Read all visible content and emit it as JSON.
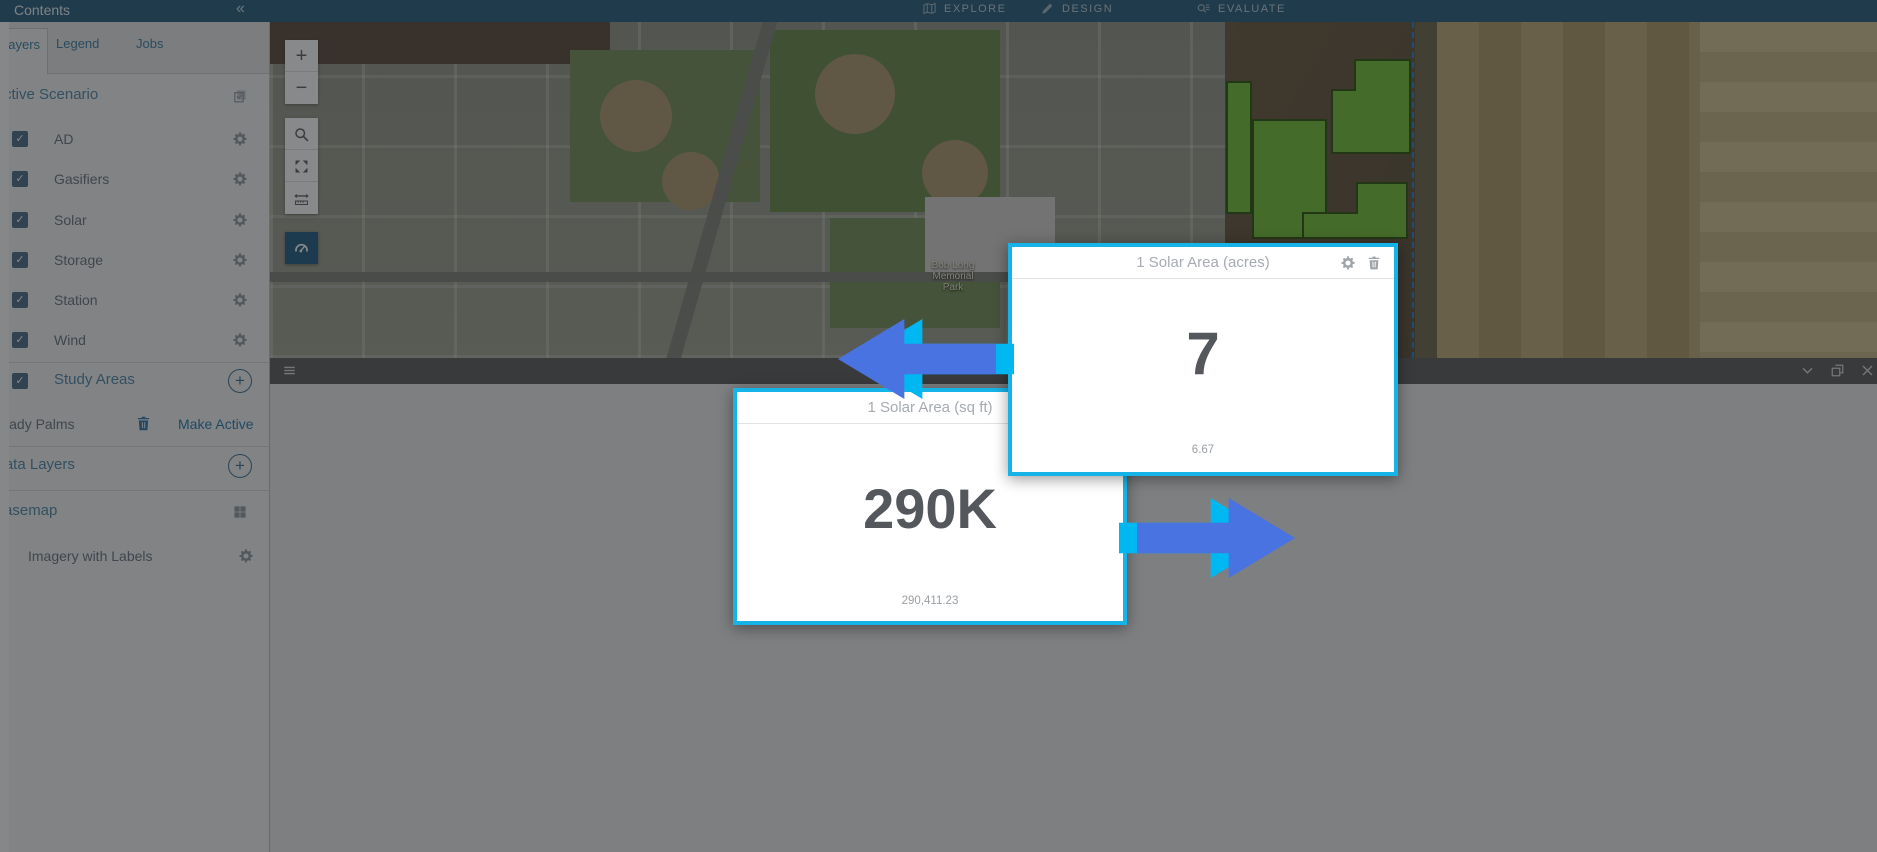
{
  "icons": {
    "plus": "+",
    "collapse": "«",
    "check": "✓",
    "zoom_in": "+",
    "zoom_out": "−"
  },
  "topbar": {
    "contents_title": "Contents",
    "explore": "EXPLORE",
    "design": "DESIGN",
    "evaluate": "EVALUATE"
  },
  "sidebar": {
    "tabs": {
      "layers": "Layers",
      "legend": "Legend",
      "jobs": "Jobs"
    },
    "active_scenario_label": "Active Scenario",
    "layers": [
      {
        "name": "AD"
      },
      {
        "name": "Gasifiers"
      },
      {
        "name": "Solar"
      },
      {
        "name": "Storage"
      },
      {
        "name": "Station"
      },
      {
        "name": "Wind"
      }
    ],
    "study_areas_label": "Study Areas",
    "study_area": {
      "name": "Shady Palms",
      "action": "Make Active"
    },
    "data_layers_label": "Data Layers",
    "basemap_label": "Basemap",
    "basemap_layer": "Imagery with Labels"
  },
  "map": {
    "park_label": [
      "Bob Long",
      "Memorial",
      "Park"
    ]
  },
  "dashboard": {
    "design_chart": {
      "title": "Design Chart",
      "left_select": "Solar",
      "right_select": "solar test",
      "footer": "Solar Lizard",
      "left_pie": "#68aa37 0deg 360deg",
      "right_pie": "#7d923f 0deg 25deg, #41703a 25deg 95deg, #57973d 95deg 130deg, #7d923f 130deg 360deg"
    },
    "solar_area_sqft": {
      "title": "1 Solar Area (sq ft)",
      "value": "290K",
      "footer": "290,411.23"
    },
    "solar_area_acres": {
      "title": "1 Solar Area (acres)",
      "value": "7",
      "footer": "6.67"
    },
    "est_generation": {
      "title": "1 Estimated Generation Potential Solar (Kw)",
      "value": "38K",
      "footer": "38,101.95",
      "ticks": [
        "0",
        "15,000",
        "30,000",
        "45,000",
        "60,000"
      ],
      "arc": "#43a689 0deg 135deg, transparent 135deg 225deg, #c2574d 225deg 270deg, #d9b942 270deg 360deg",
      "needle_deg": "36deg"
    },
    "num_panels": {
      "title": "1 Number of Solar Panels",
      "value": "27K",
      "footer": "27,170.86"
    },
    "cost_panels": {
      "title": "1 Cost Solar Panels ($)",
      "value": "6M",
      "footer": "5,678,710.12",
      "ticks": [
        "0",
        "2,500,000",
        "5,000,000",
        "7,500,000",
        "10,000,000"
      ],
      "arc": "#d9b942 0deg 90deg, #c2574d 90deg 135deg, transparent 135deg 225deg, #43a689 225deg 270deg, #d9b942 270deg 360deg",
      "needle_deg": "18deg"
    }
  },
  "colors": {
    "highlight_border": "#16b3e8",
    "arrow_blue": "#4a73e2",
    "arrow_cyan": "#00b8f1"
  },
  "chart_data": [
    {
      "type": "pie",
      "title": "Design Chart (Solar)",
      "labels": [
        "Solar"
      ],
      "values": [
        100
      ]
    },
    {
      "type": "pie",
      "title": "Design Chart (solar test)",
      "labels": [
        "segment-1",
        "segment-2",
        "segment-3"
      ],
      "values": [
        19,
        10,
        71
      ]
    },
    {
      "type": "gauge",
      "title": "1 Estimated Generation Potential Solar (Kw)",
      "value": 38101.95,
      "display": "38K",
      "min": 0,
      "max": 60000,
      "ticks": [
        0,
        15000,
        30000,
        45000,
        60000
      ]
    },
    {
      "type": "gauge",
      "title": "1 Cost Solar Panels ($)",
      "value": 5678710.12,
      "display": "6M",
      "min": 0,
      "max": 10000000,
      "ticks": [
        0,
        2500000,
        5000000,
        7500000,
        10000000
      ]
    },
    {
      "type": "indicator",
      "title": "1 Solar Area (sq ft)",
      "value": 290411.23,
      "display": "290K"
    },
    {
      "type": "indicator",
      "title": "1 Solar Area (acres)",
      "value": 6.67,
      "display": "7"
    },
    {
      "type": "indicator",
      "title": "1 Number of Solar Panels",
      "value": 27170.86,
      "display": "27K"
    }
  ]
}
